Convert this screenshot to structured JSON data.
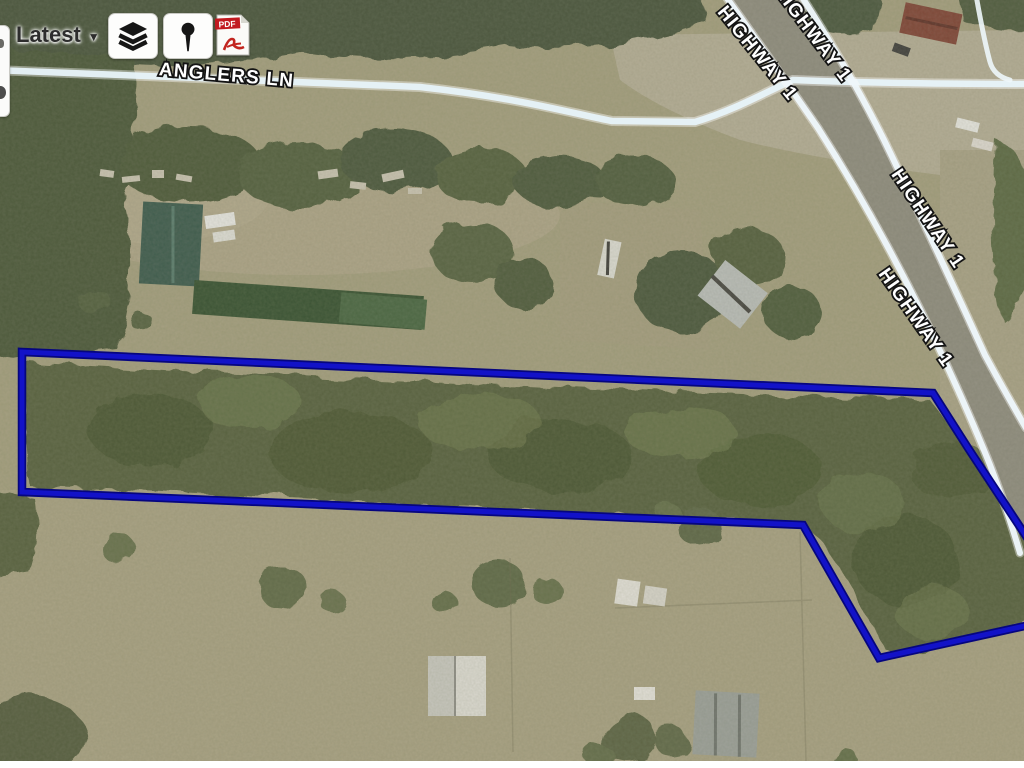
{
  "toolbar": {
    "latest": {
      "label": "Latest",
      "arrow": "▼"
    },
    "layers_button": {
      "icon": "layers-icon"
    },
    "marker_button": {
      "icon": "pin-icon"
    },
    "pdf_button": {
      "icon": "pdf-icon",
      "badge": "PDF"
    }
  },
  "map": {
    "labels": {
      "anglers": "ANGLERS LN",
      "highway_top_left": "HIGHWAY 1",
      "highway_top_right": "HIGHWAY 1",
      "highway_right_upper": "HIGHWAY 1",
      "highway_right_lower": "HIGHWAY 1"
    },
    "parcel": {
      "color": "#0d0dbe",
      "points": "22,352 933,393 968,448 1024,533 1048,570 1043,622 879,658 803,525 22,492"
    },
    "roads": {
      "anglers_d": "M -6,70 C 120,75 300,82 420,87 C 520,98 575,114 612,121 L 695,122 C 735,110 766,92 793,80 C 870,83 950,84 1030,84",
      "highway_west_d": "M 724,-6 Q 778,70 818,128 Q 880,225 935,340 Q 968,410 990,465 Q 1008,512 1020,553",
      "highway_east_d": "M 800,-6 Q 848,68 884,140 Q 935,245 985,355 Q 1005,392 1026,428",
      "frontage_d": "M 976,-5 Q 984,40 990,62 Q 994,76 1010,80",
      "pavement_d": "M 724,-6 Q 778,70 818,128 Q 880,225 935,340 Q 968,410 990,465 Q 1008,512 1020,553 L 1024,553 L 1024,428 Q 1005,392 985,355 Q 935,245 884,140 Q 848,68 800,-6 Z"
    }
  }
}
